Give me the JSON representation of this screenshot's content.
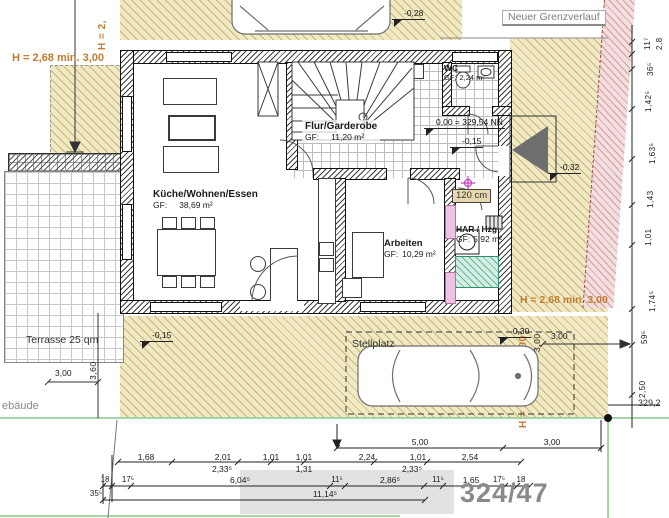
{
  "site": {
    "boundary_label": "Neuer Grenzverlauf",
    "parcel_number": "324/47",
    "neighbor_building_partial": "ebäude",
    "terrace_label": "Terrasse 25 qm",
    "parking_label": "Stellplatz",
    "door_note": "120 cm"
  },
  "heights": {
    "left_partial": "H = 2,",
    "left": "H = 2,68 min. 3,00",
    "right": "H = 2,68 min. 3,00",
    "right_vertical": "H = 2,68 min. 3,00"
  },
  "levels": {
    "garage": "-0,28",
    "floor_zero": "0,00 = 329,54 NN",
    "flur": "-0,15",
    "entry": "-0,32",
    "parking": "-0,30",
    "terrace": "-0,15",
    "boundary_elevation": "329,2"
  },
  "rooms": [
    {
      "name": "Küche/Wohnen/Essen",
      "gf": "GF:",
      "area": "38,69 m²"
    },
    {
      "name": "Flur/Garderobe",
      "gf": "GF:",
      "area": "11,20 m²"
    },
    {
      "name": "WC",
      "gf": "GF:",
      "area": "2,24 m²"
    },
    {
      "name": "Arbeiten",
      "gf": "GF:",
      "area": "10,29 m²"
    },
    {
      "name": "HAR / Hzg",
      "gf": "GF:",
      "area": "5,92 m²"
    }
  ],
  "dimensions": {
    "overall": [
      "5,00",
      "3,00"
    ],
    "row1": [
      "1,68",
      "2,01",
      "1,01",
      "1,01",
      "2,24",
      "1,01",
      "2,54"
    ],
    "row2": [
      "2,33⁵",
      "1,31",
      "2,33⁵"
    ],
    "row3": [
      "18",
      "17⁵",
      "6,04⁵",
      "11⁵",
      "2,86⁵",
      "11⁵",
      "1,65",
      "17⁵",
      "18"
    ],
    "row4": [
      "35⁵",
      "11,14⁵"
    ],
    "right_column": [
      "2,8",
      "11⁷",
      "36⁵",
      "1,42⁵",
      "1,63⁵",
      "1,43",
      "1,01",
      "1,74⁵",
      "59⁵",
      "2,50"
    ],
    "right_offset": "3,00",
    "right_offset_vertical": "3,00",
    "terrace_width": "3,00",
    "terrace_depth": "3,60"
  }
}
